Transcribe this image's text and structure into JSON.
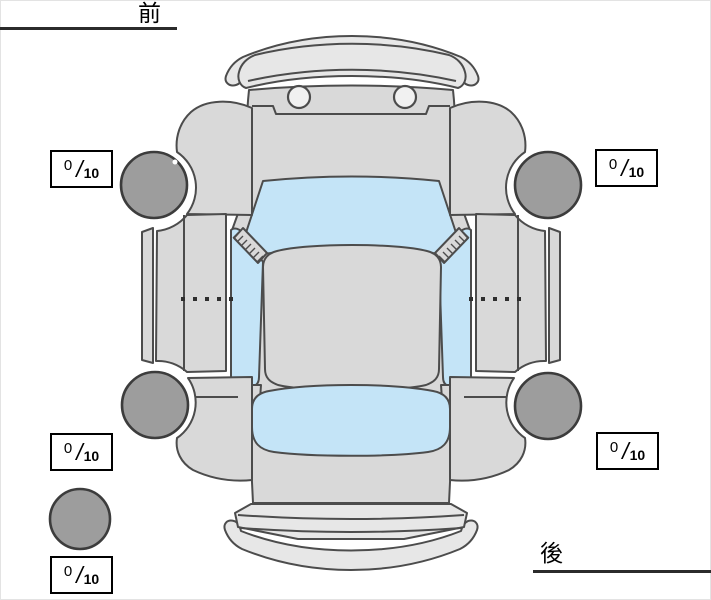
{
  "labels": {
    "front": "前",
    "rear": "後"
  },
  "scores": {
    "front_left": {
      "value": "0",
      "slash": "/",
      "denominator": "10"
    },
    "front_right": {
      "value": "0",
      "slash": "/",
      "denominator": "10"
    },
    "rear_left": {
      "value": "0",
      "slash": "/",
      "denominator": "10"
    },
    "rear_right": {
      "value": "0",
      "slash": "/",
      "denominator": "10"
    },
    "spare": {
      "value": "0",
      "slash": "/",
      "denominator": "10"
    }
  },
  "colors": {
    "background": "#ffffff",
    "body": "#d9d9d9",
    "body_light": "#e7e7e7",
    "glass": "#c4e4f7",
    "tire": "#9d9d9d",
    "outline": "#4c4c4c",
    "box_border": "#000000",
    "underline": "#2b2b2b",
    "text": "#000000"
  },
  "diagram": {
    "view": "car-top-view",
    "wheels": [
      "front-left",
      "front-right",
      "rear-left",
      "rear-right",
      "spare"
    ]
  }
}
